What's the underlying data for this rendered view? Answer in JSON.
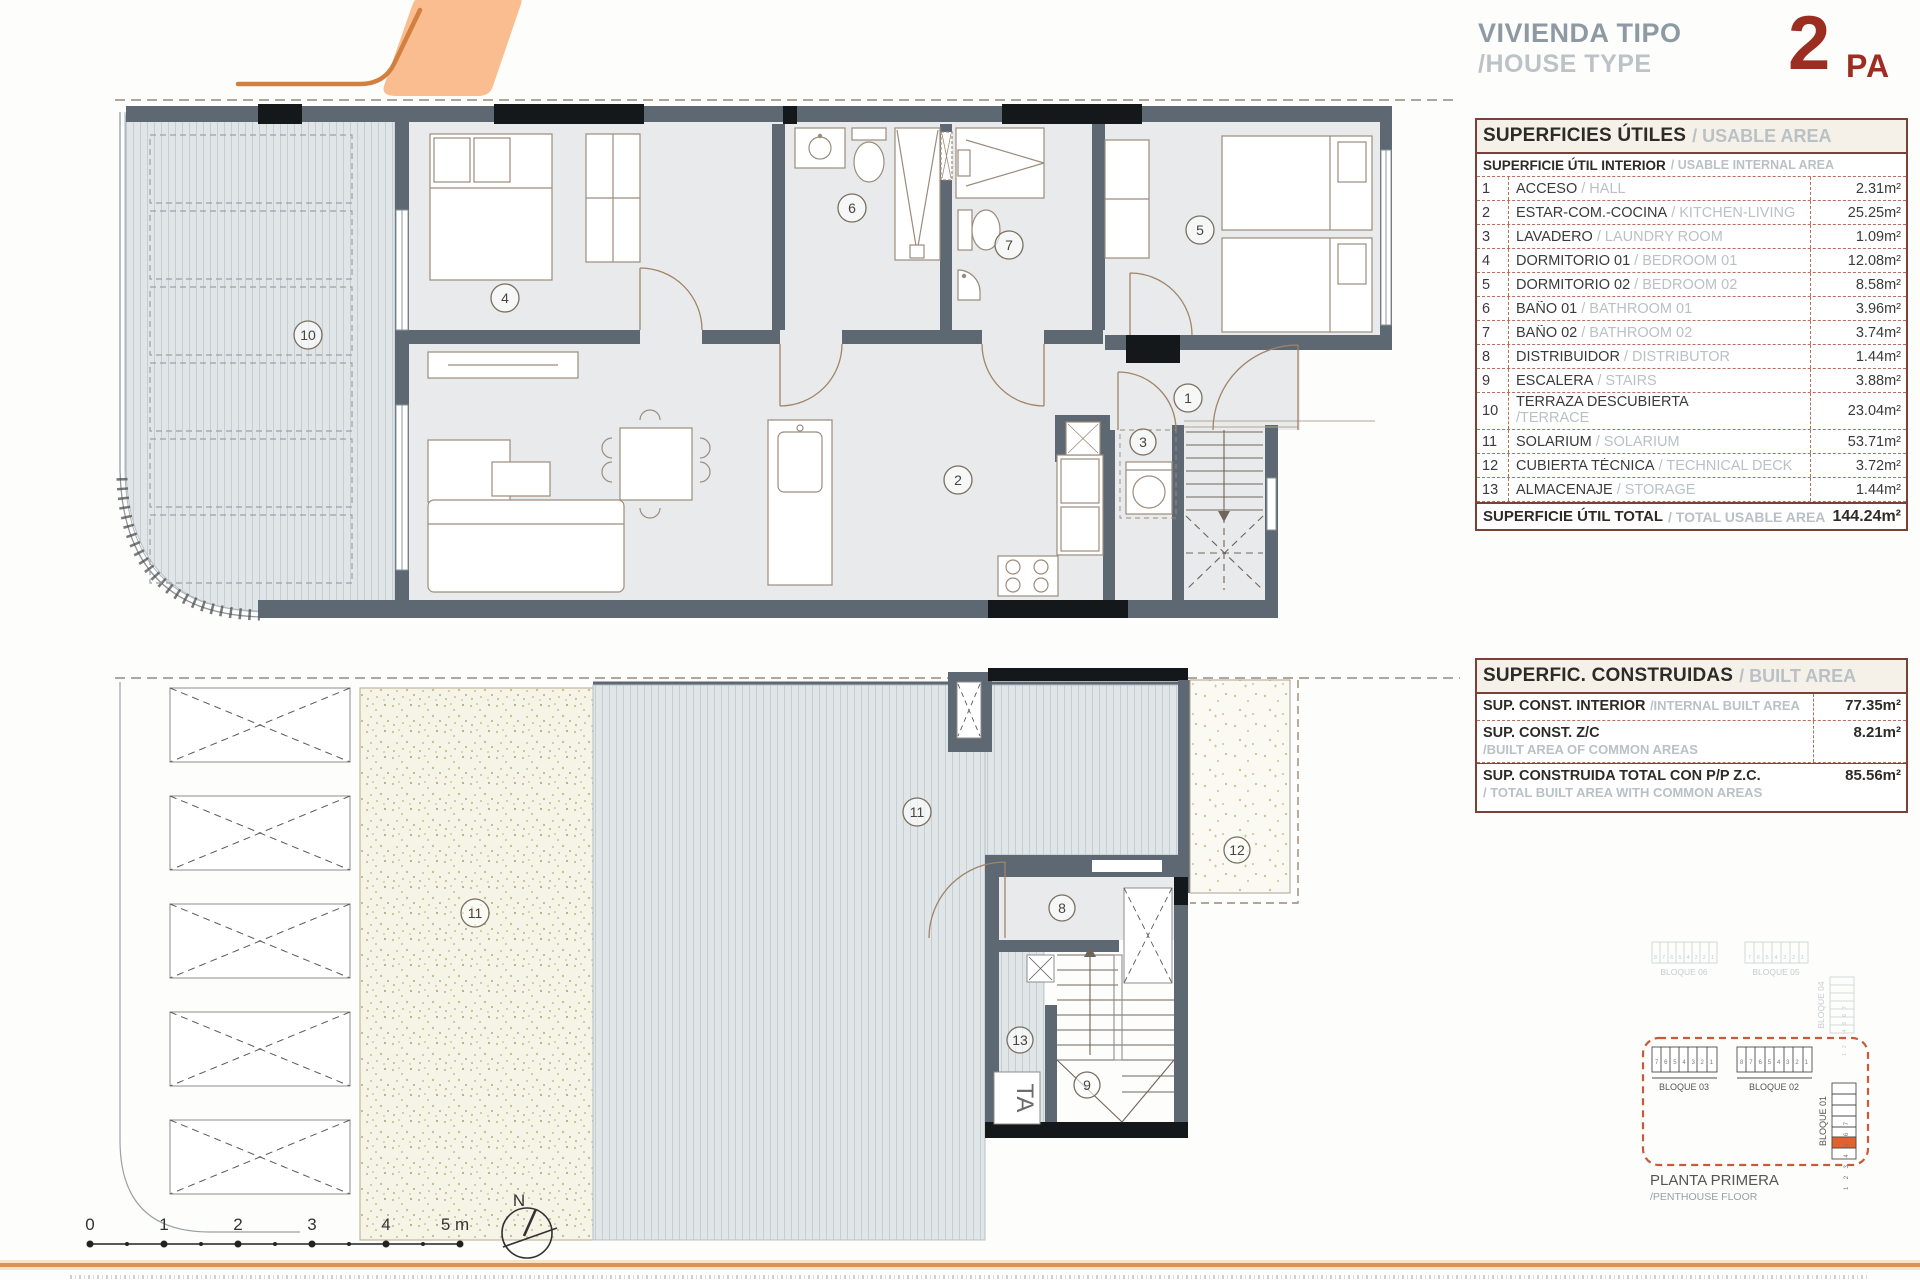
{
  "header": {
    "title_es": "VIVIENDA TIPO",
    "title_en": "/HOUSE TYPE",
    "type_number": "2",
    "type_suffix": "PA"
  },
  "usable": {
    "title_es": "SUPERFICIES ÚTILES",
    "title_en": "/ USABLE AREA",
    "sub_es": "SUPERFICIE ÚTIL INTERIOR",
    "sub_en": "/ USABLE INTERNAL AREA",
    "rows": [
      {
        "num": "1",
        "es": "ACCESO",
        "en": "/ HALL",
        "value": "2.31m²"
      },
      {
        "num": "2",
        "es": "ESTAR-COM.-COCINA",
        "en": "/ KITCHEN-LIVING",
        "value": "25.25m²"
      },
      {
        "num": "3",
        "es": "LAVADERO",
        "en": "/ LAUNDRY ROOM",
        "value": "1.09m²"
      },
      {
        "num": "4",
        "es": "DORMITORIO 01",
        "en": "/ BEDROOM 01",
        "value": "12.08m²"
      },
      {
        "num": "5",
        "es": "DORMITORIO 02",
        "en": "/ BEDROOM 02",
        "value": "8.58m²"
      },
      {
        "num": "6",
        "es": "BAÑO 01",
        "en": "/ BATHROOM 01",
        "value": "3.96m²"
      },
      {
        "num": "7",
        "es": "BAÑO 02",
        "en": "/ BATHROOM 02",
        "value": "3.74m²"
      },
      {
        "num": "8",
        "es": "DISTRIBUIDOR",
        "en": "/ DISTRIBUTOR",
        "value": "1.44m²"
      },
      {
        "num": "9",
        "es": "ESCALERA",
        "en": "/ STAIRS",
        "value": "3.88m²"
      },
      {
        "num": "10",
        "es": "TERRAZA DESCUBIERTA",
        "en": "/TERRACE",
        "value": "23.04m²"
      },
      {
        "num": "11",
        "es": "SOLARIUM",
        "en": "/ SOLARIUM",
        "value": "53.71m²"
      },
      {
        "num": "12",
        "es": "CUBIERTA TÉCNICA",
        "en": "/ TECHNICAL DECK",
        "value": "3.72m²"
      },
      {
        "num": "13",
        "es": "ALMACENAJE",
        "en": "/ STORAGE",
        "value": "1.44m²"
      }
    ],
    "total_es": "SUPERFICIE ÚTIL TOTAL",
    "total_en": "/ TOTAL USABLE AREA",
    "total_value": "144.24m²"
  },
  "built": {
    "title_es": "SUPERFIC. CONSTRUIDAS",
    "title_en": "/ BUILT AREA",
    "rows": [
      {
        "es": "SUP. CONST. INTERIOR",
        "en": "/INTERNAL BUILT AREA",
        "value": "77.35m²"
      },
      {
        "es": "SUP. CONST. Z/C",
        "en": "/BUILT AREA OF COMMON AREAS",
        "value": "8.21m²"
      },
      {
        "es": "SUP. CONSTRUIDA TOTAL CON P/P Z.C.",
        "en": "/ TOTAL BUILT AREA WITH COMMON AREAS",
        "value": "85.56m²"
      }
    ]
  },
  "keyplan": {
    "b06": "BLOQUE 06",
    "b05": "BLOQUE 05",
    "b04": "BLOQUE 04",
    "b03": "BLOQUE 03",
    "b02": "BLOQUE 02",
    "b01": "BLOQUE 01",
    "cells_b06": "8 7 6 5 4 3 2 1",
    "cells_b05": "7 6 5 4 3 2 1",
    "cells_b04": "1 2 3 4 5 6 7",
    "cells_b03": "7 6 5 4 3 2 1",
    "cells_b02": "8 7 6 5 4 3 2 1",
    "cells_b01": "1 2 3 4 5 6 7",
    "caption1": "PLANTA PRIMERA",
    "caption2": "/PENTHOUSE FLOOR"
  },
  "floorplans": {
    "top_rooms": [
      "10",
      "4",
      "6",
      "7",
      "5",
      "2",
      "1",
      "3"
    ],
    "bottom_rooms": [
      "11",
      "11",
      "8",
      "9",
      "13",
      "12"
    ],
    "storage_tag": "TA"
  },
  "scalebar": {
    "labels": [
      "0",
      "1",
      "2",
      "3",
      "4",
      "5 m"
    ]
  },
  "compass": {
    "north": "N"
  },
  "colors": {
    "accent_orange": "#e2612c",
    "logo_orange_fill": "#f9bd8f",
    "logo_orange_line": "#d2803f",
    "maroon": "#9c2d21",
    "table_border": "#7a4136",
    "table_dash": "#b5705a",
    "wall_gray": "#5d6872",
    "title_gray": "#8d99a3",
    "muted_gray": "#b9c1c6"
  }
}
